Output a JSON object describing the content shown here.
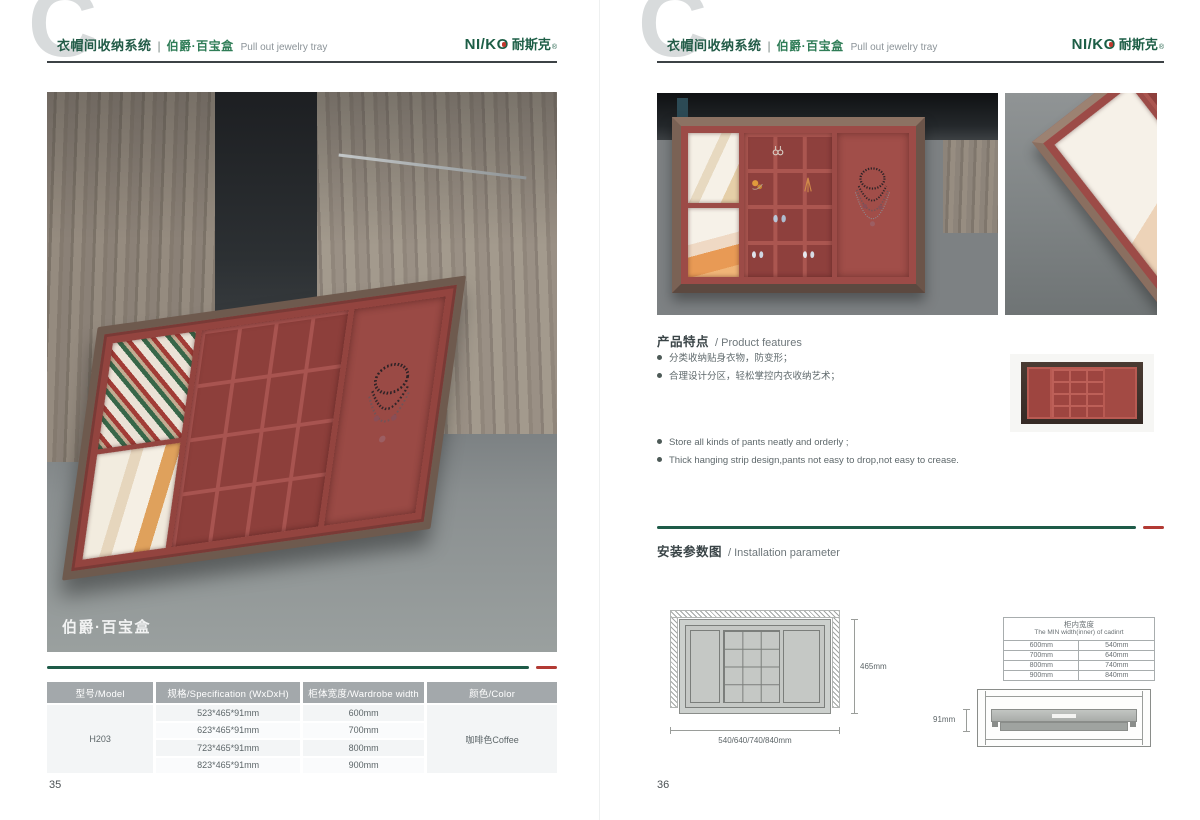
{
  "brand": {
    "name_latin": "NI/KO",
    "name_cn": "耐斯克",
    "reg": "®"
  },
  "header": {
    "watermark": "C",
    "category": "衣帽间收纳系统",
    "separator": "|",
    "product_cn": "伯爵·百宝盒",
    "product_en": "Pull out jewelry tray"
  },
  "left_page": {
    "photo_caption": "伯爵·百宝盒",
    "page_number": "35",
    "spec_table": {
      "headers": [
        "型号/Model",
        "规格/Specification (WxDxH)",
        "柜体宽度/Wardrobe width",
        "颜色/Color"
      ],
      "model": "H203",
      "rows": [
        {
          "spec": "523*465*91mm",
          "width": "600mm"
        },
        {
          "spec": "623*465*91mm",
          "width": "700mm"
        },
        {
          "spec": "723*465*91mm",
          "width": "800mm"
        },
        {
          "spec": "823*465*91mm",
          "width": "900mm"
        }
      ],
      "color": "咖啡色Coffee"
    }
  },
  "right_page": {
    "page_number": "36",
    "features": {
      "title_cn": "产品特点",
      "title_en": "/ Product features",
      "bullets_cn": [
        "分类收纳贴身衣物，防变形；",
        "合理设计分区，轻松掌控内衣收纳艺术；"
      ],
      "bullets_en": [
        "Store all kinds of pants neatly and orderly ;",
        "Thick hanging strip design,pants not easy to drop,not easy to crease."
      ]
    },
    "installation": {
      "title_cn": "安装参数图",
      "title_en": "/ Installation parameter",
      "top_view": {
        "depth_label": "465mm",
        "width_label": "540/640/740/840mm"
      },
      "side_view": {
        "height_label": "91mm"
      },
      "width_table": {
        "header_cn": "柜内宽度",
        "header_en": "The MIN width(inner) of cadinrt",
        "rows": [
          [
            "600mm",
            "540mm"
          ],
          [
            "700mm",
            "640mm"
          ],
          [
            "800mm",
            "740mm"
          ],
          [
            "900mm",
            "840mm"
          ]
        ]
      }
    }
  }
}
